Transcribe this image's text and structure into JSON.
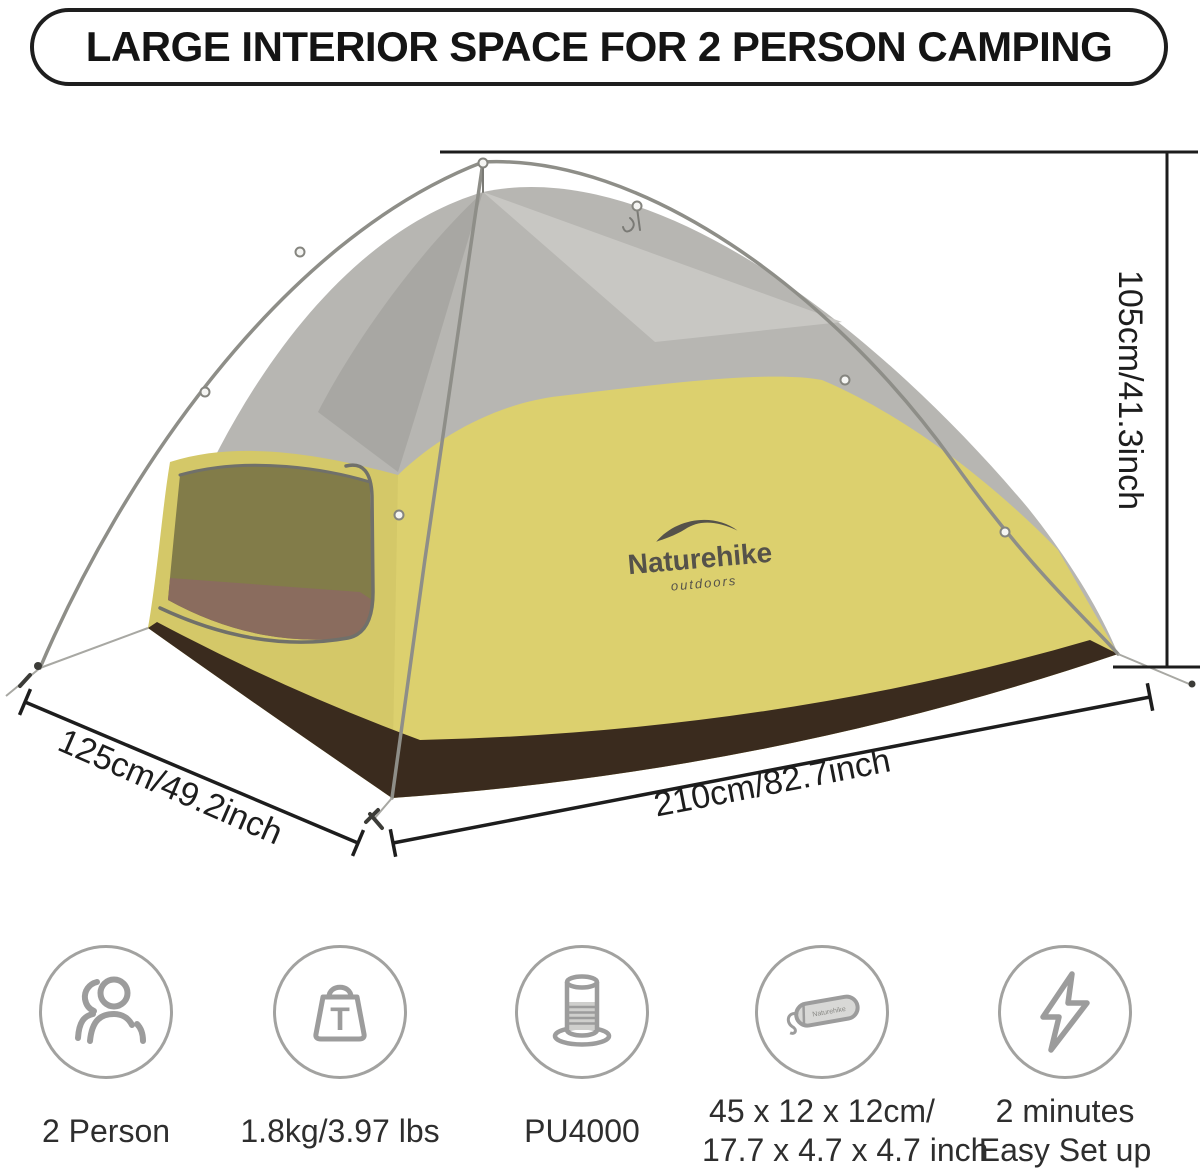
{
  "title": "LARGE INTERIOR SPACE FOR 2 PERSON CAMPING",
  "brand": {
    "name": "Naturehike",
    "tagline": "outdoors"
  },
  "dimensions": {
    "height": "105cm/41.3inch",
    "width": "125cm/49.2inch",
    "length": "210cm/82.7inch"
  },
  "features": [
    {
      "name": "capacity",
      "icon": "people-icon",
      "lines": [
        "2 Person"
      ]
    },
    {
      "name": "weight",
      "icon": "weight-icon",
      "glyph": "T",
      "lines": [
        "1.8kg/3.97 lbs"
      ]
    },
    {
      "name": "waterproof",
      "icon": "water-column-icon",
      "lines": [
        "PU4000"
      ]
    },
    {
      "name": "packed-size",
      "icon": "storage-bag-icon",
      "lines": [
        "45 x 12 x 12cm/",
        "17.7 x 4.7 x 4.7 inch"
      ]
    },
    {
      "name": "setup-time",
      "icon": "lightning-icon",
      "lines": [
        "2 minutes",
        "Easy Set up"
      ]
    }
  ],
  "colors": {
    "rainfly_yellow": "#dcd06e",
    "mesh_gray": "#b7b6b2",
    "floor_brown": "#3a2b1e",
    "inner_floor_mauve": "#8a6c5e",
    "door_mesh_olive": "#827c49",
    "pole_gray": "#8e8e88",
    "dimension_line": "#1d1d1d",
    "icon_gray": "#9c9c9c",
    "label_text": "#2e2e2e"
  }
}
